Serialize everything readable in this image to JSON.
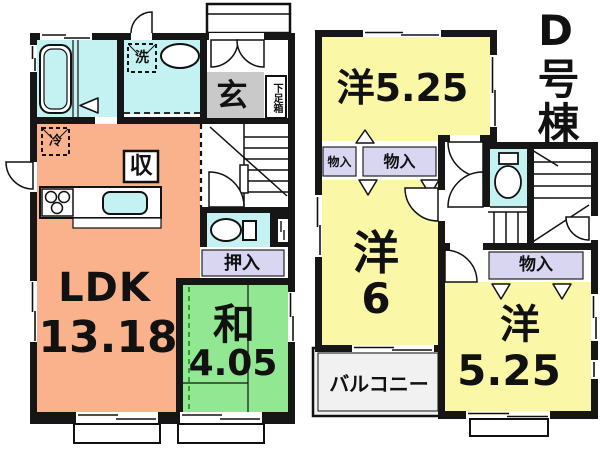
{
  "building_label": {
    "text": "D号棟"
  },
  "floor1": {
    "ldk_name": "LDK",
    "ldk_size": "13.18",
    "washitsu_name": "和",
    "washitsu_size": "4.05",
    "entrance_label": "玄",
    "shoe_box_label": "下足箱",
    "oshiire_label": "押入",
    "washer_label": "洗",
    "fridge_label": "冷",
    "storage_label": "収"
  },
  "floor2": {
    "room_top_label": "洋5.25",
    "room_mid_name": "洋",
    "room_mid_size": "6",
    "room_bottom_name": "洋",
    "room_bottom_size": "5.25",
    "balcony_label": "バルコニー",
    "closet_top_left_label": "物入",
    "closet_top_right_label": "物入",
    "closet_bottom_label": "物入"
  },
  "colors": {
    "ldk": "#F9B28C",
    "tatami_room": "#92E892",
    "western_room": "#FAF8A6",
    "wet_area": "#C4F1F1",
    "closet": "#D8D6F0",
    "entrance": "#C9C9C9",
    "balcony": "#F1F1F1",
    "wall": "#161616"
  }
}
